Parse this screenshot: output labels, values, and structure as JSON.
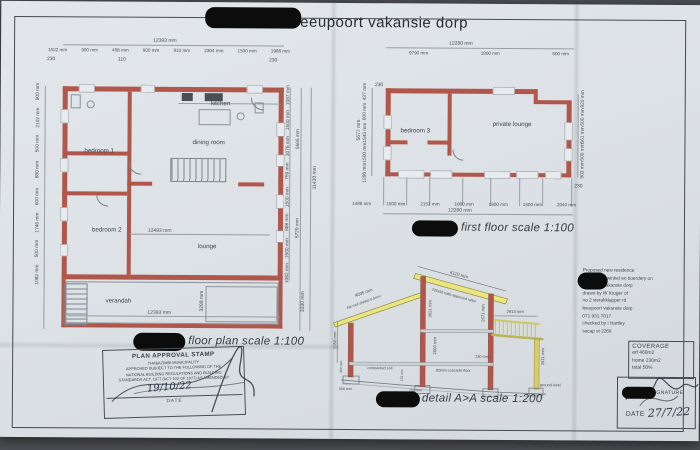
{
  "title": "eeupoort vakansie dorp",
  "floor_plan": {
    "caption": "floor plan scale 1:100",
    "top_total": "12393 mm",
    "top_dims": [
      "1522 mm",
      "900 mm",
      "488 mm",
      "900 mm",
      "910 mm",
      "2304 mm",
      "1500 mm",
      "1988 mm"
    ],
    "tick_left": "230",
    "tick_mid": "110",
    "tick_right": "230",
    "rooms": {
      "bedroom1": "bedroom 1",
      "bedroom2": "bedroom 2",
      "dining": "dining room",
      "kitchen": "kitchen",
      "lounge": "lounge",
      "verandah": "verandah"
    },
    "lounge_width": "12493 mm",
    "left_dims": [
      "900 mm",
      "2102 mm",
      "500 mm",
      "880 mm",
      "600 mm",
      "1746 mm",
      "500 mm",
      "1082 mm"
    ],
    "right_dims": [
      "1087 mm",
      "1500 mm",
      "3078 mm",
      "759 mm",
      "1500 mm",
      "888 mm",
      "1500 mm",
      "1082 mm"
    ],
    "right_mid_dims": [
      "5665 mm",
      "5729 mm"
    ],
    "right_total": "11430 mm",
    "verandah_depth": "3298 mm",
    "verandah_side": "3330 mm",
    "bottom_total": "12393 mm"
  },
  "first_floor": {
    "caption": "first floor scale 1:100",
    "top_total": "12280 mm",
    "top_dims": [
      "9790 mm",
      "1800 mm",
      "600 mm"
    ],
    "rooms": {
      "bedroom3": "bedroom 3",
      "lounge": "private lounge"
    },
    "left_dims": [
      "437 mm",
      "600 mm",
      "1543 mm",
      "1500 mm",
      "1296 mm"
    ],
    "left_total": "5677 mm",
    "right_dims": [
      "920 mm",
      "500 mm",
      "561 mm",
      "500 mm",
      "903 mm"
    ],
    "bottom_dims": [
      "1488 mm",
      "1500 mm",
      "2152 mm",
      "1800 mm",
      "1900 mm",
      "1500 mm",
      "2040 mm"
    ],
    "bottom_total": "12280 mm",
    "tick": "230"
  },
  "section": {
    "caption": "detail A>A scale 1:200",
    "roof_len": "6119 mm",
    "rafter_note": "228x50 sabs approved rafter",
    "flat_roof_len": "4035 mm",
    "flat_roof_note": "flat roof sheets 0.5mm",
    "left_height": "2958 mm",
    "left_plinth": "300 mm",
    "left_footing": "500 mm",
    "wall_height": "3621 mm",
    "deck_wall": "2671 mm",
    "deck_width": "2913 mm",
    "room_height": "2600 mm",
    "step": "230 mm",
    "floor_note": "80mm concrete floor",
    "soil_note": "compacted soil",
    "footing_depth": "375 mm",
    "footing_width": "750 mm",
    "deck_height": "2611 mm",
    "ground_label": "ground level"
  },
  "notes": {
    "lines": [
      "Proposed new residence",
      "for voggies winkel en boerdery on",
      "leeupoort vakansie dorp",
      "drawn by W Kruger of",
      "no 2 vierakklapper rd",
      "leeupoort vakansie dorp",
      "071 931 7017",
      "checked by I Hartley",
      "sacap st 2268"
    ]
  },
  "coverage": {
    "title": "COVERAGE",
    "lines": [
      "erf 460m2",
      "home 230m2",
      "total 50%"
    ]
  },
  "signature": {
    "label": "OWNER SIGNATURE",
    "date_label": "DATE",
    "date_value": "27/7/22"
  },
  "stamp": {
    "title": "PLAN APPROVAL STAMP",
    "lines": [
      "THABAZIMBI MUNICIPALITY",
      "APPROVED SUBJECT TO THE FOLLOWING OF THE",
      "NATIONAL BUILDING REGULATIONS AND BUILDING",
      "STANDARDS ACT, 1977 (ACT 103 OF 1977) AS AMENDED BY"
    ],
    "hw_date": "19/10/22",
    "date_label": "DATE"
  }
}
